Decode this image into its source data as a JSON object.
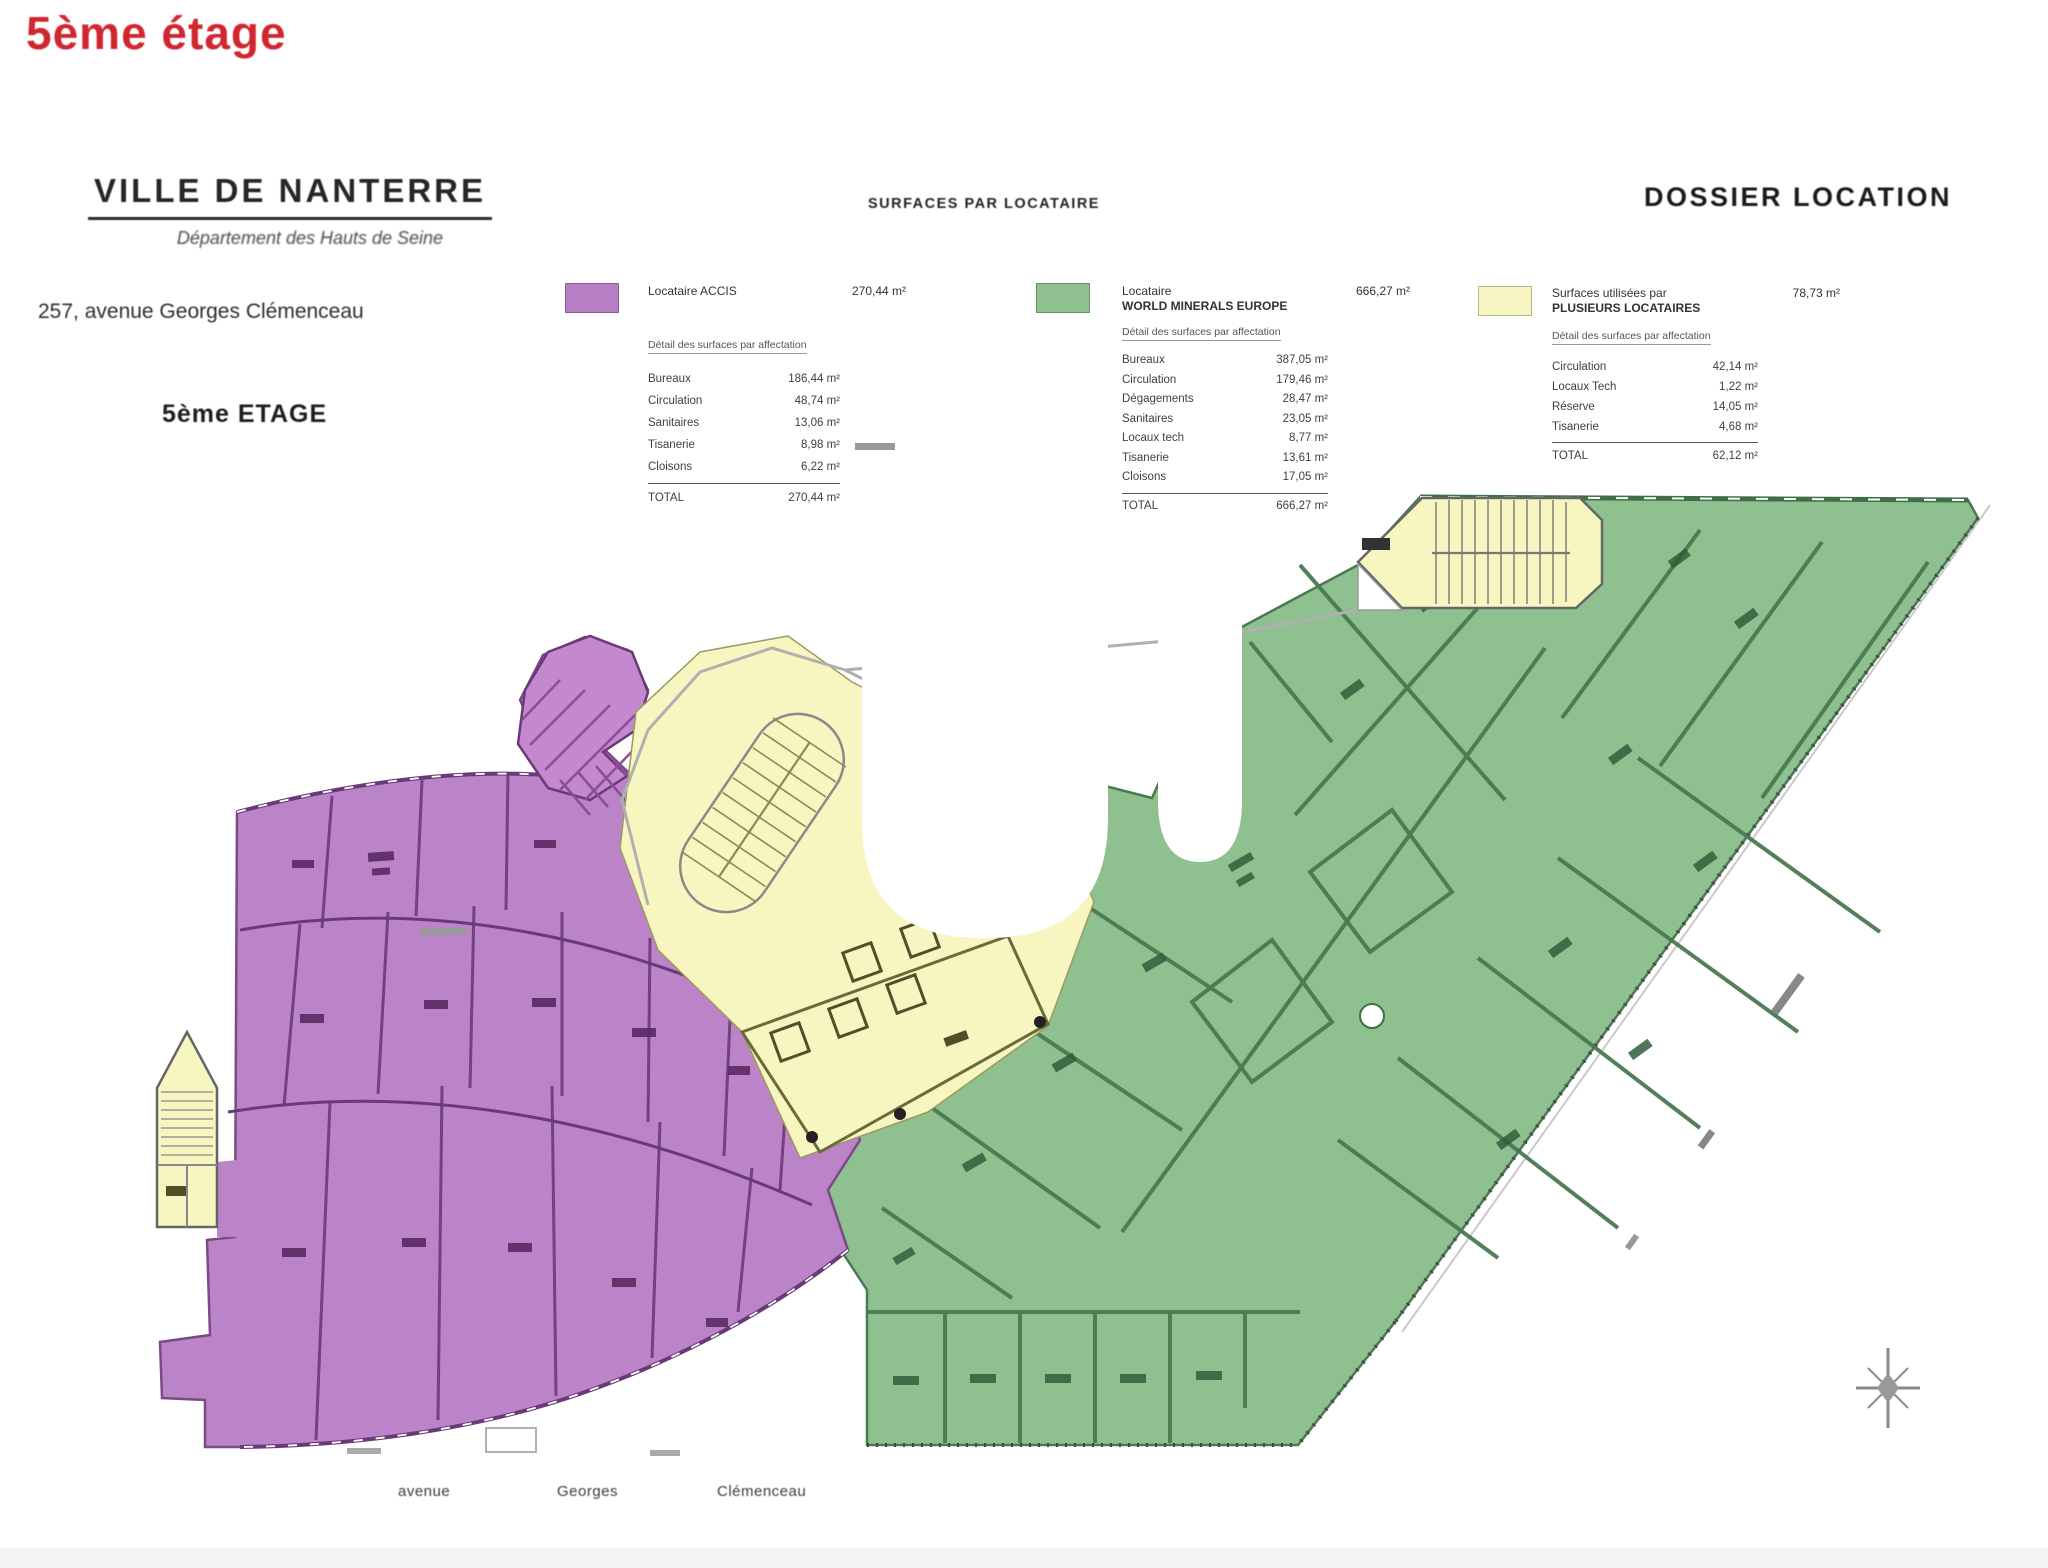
{
  "page": {
    "floor_title": "5ème étage"
  },
  "header": {
    "city": "VILLE DE NANTERRE",
    "department": "Département des Hauts de Seine",
    "address": "257, avenue Georges Clémenceau",
    "floor_label": "5ème ETAGE"
  },
  "section_titles": {
    "center": "SURFACES PAR LOCATAIRE",
    "right": "DOSSIER LOCATION"
  },
  "legend": [
    {
      "zone": "purple",
      "color": "#b87fc6",
      "tenant_line1": "Locataire ACCIS",
      "tenant_line2": "",
      "area": "270,44 m²",
      "detail_heading": "Détail des surfaces par affectation",
      "rows": [
        {
          "label": "Bureaux",
          "value": "186,44 m²"
        },
        {
          "label": "Circulation",
          "value": "48,74 m²"
        },
        {
          "label": "Sanitaires",
          "value": "13,06 m²"
        },
        {
          "label": "Tisanerie",
          "value": "8,98 m²"
        },
        {
          "label": "Cloisons",
          "value": "6,22 m²"
        }
      ],
      "total_label": "TOTAL",
      "total_value": "270,44 m²"
    },
    {
      "zone": "green",
      "color": "#8fc08f",
      "tenant_line1": "Locataire",
      "tenant_line2": "WORLD MINERALS EUROPE",
      "area": "666,27 m²",
      "detail_heading": "Détail des surfaces par affectation",
      "rows": [
        {
          "label": "Bureaux",
          "value": "387,05 m²"
        },
        {
          "label": "Circulation",
          "value": "179,46 m²"
        },
        {
          "label": "Dégagements",
          "value": "28,47 m²"
        },
        {
          "label": "Sanitaires",
          "value": "23,05 m²"
        },
        {
          "label": "Locaux tech",
          "value": "8,77 m²"
        },
        {
          "label": "Tisanerie",
          "value": "13,61 m²"
        },
        {
          "label": "Cloisons",
          "value": "17,05 m²"
        }
      ],
      "total_label": "TOTAL",
      "total_value": "666,27 m²"
    },
    {
      "zone": "yellow",
      "color": "#f6f4c0",
      "tenant_line1": "Surfaces utilisées par",
      "tenant_line2": "PLUSIEURS LOCATAIRES",
      "area": "78,73 m²",
      "detail_heading": "Détail des surfaces par affectation",
      "rows": [
        {
          "label": "Circulation",
          "value": "42,14 m²"
        },
        {
          "label": "Locaux Tech",
          "value": "1,22 m²"
        },
        {
          "label": "Réserve",
          "value": "14,05 m²"
        },
        {
          "label": "Tisanerie",
          "value": "4,68 m²"
        }
      ],
      "total_label": "TOTAL",
      "total_value": "62,12 m²"
    }
  ],
  "plan": {
    "streets": [
      "avenue",
      "Georges",
      "Clémenceau"
    ],
    "zone_colors": {
      "purple": "#bc84c8",
      "green": "#8fc08f",
      "yellow": "#f7f5c0"
    },
    "compass_icon": "compass-star"
  }
}
